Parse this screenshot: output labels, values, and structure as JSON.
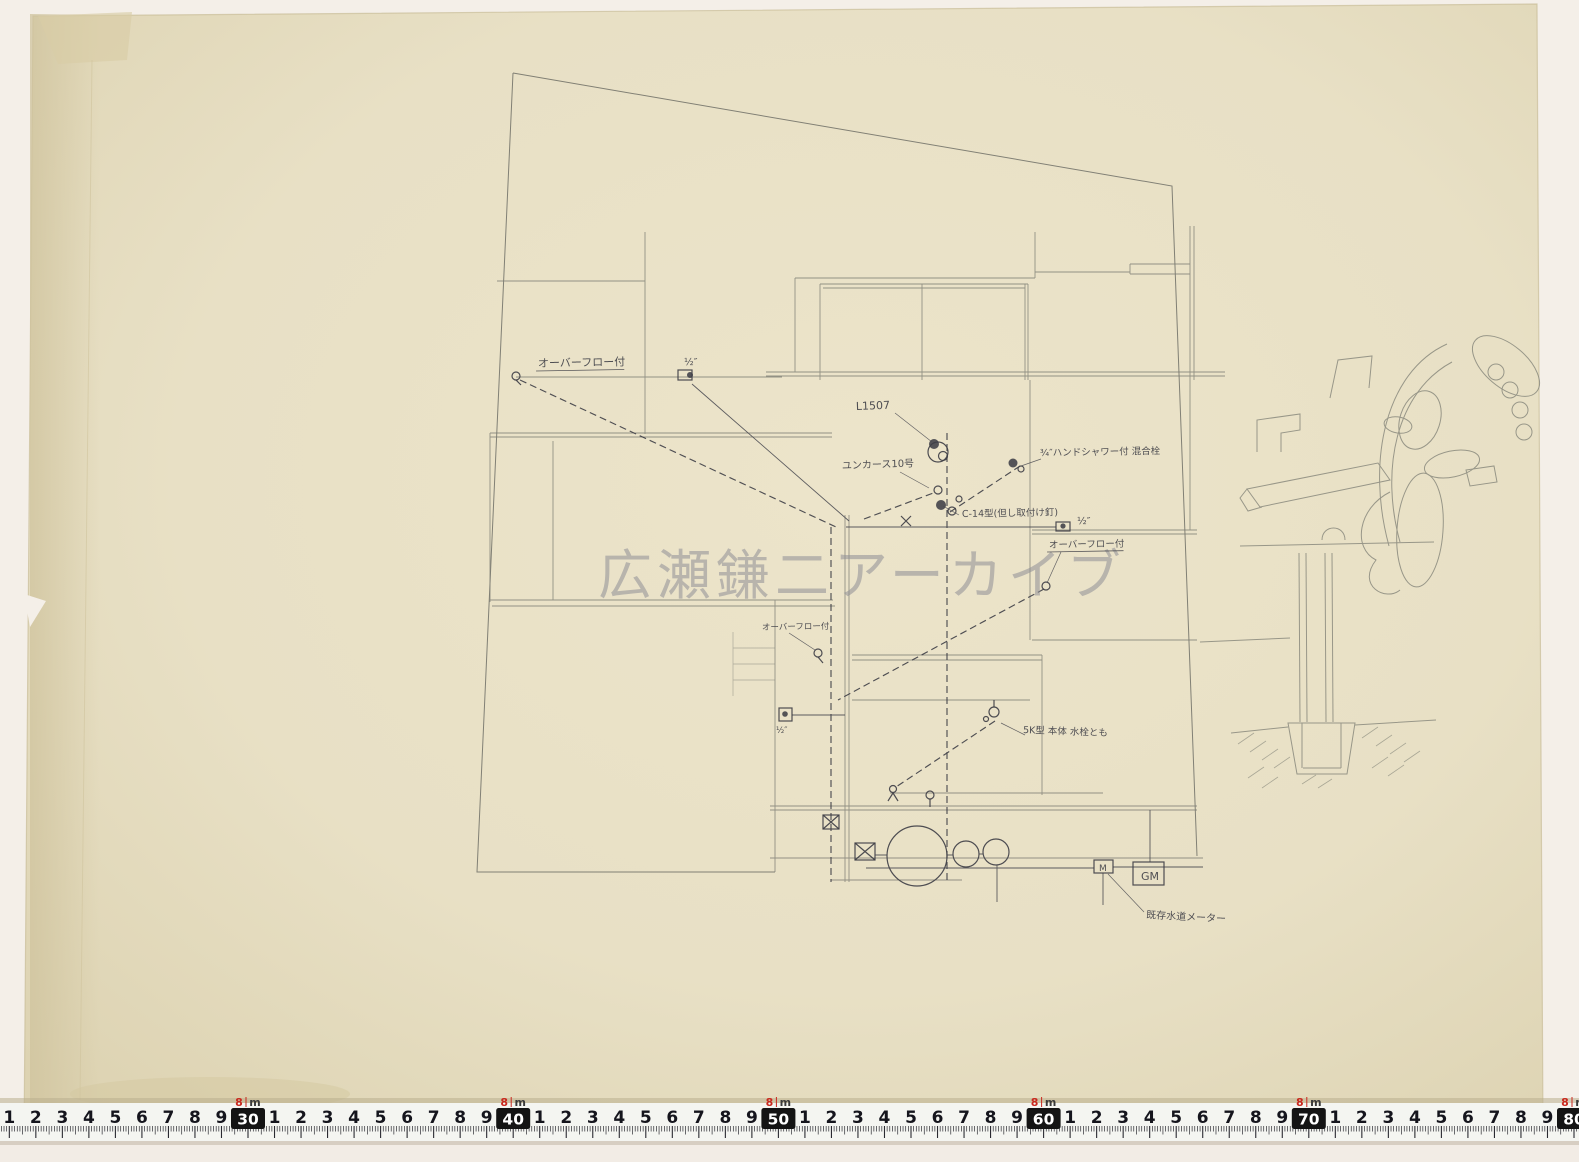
{
  "watermark": {
    "text": "広瀬鎌二アーカイブ",
    "color": "#8f8f96"
  },
  "annotations": [
    {
      "name": "note-overflow-1",
      "text": "オーバーフロー付",
      "x": 538,
      "y": 367,
      "size": 11,
      "rot": -1,
      "underline": true
    },
    {
      "name": "note-size-half-1",
      "text": "½″",
      "x": 684,
      "y": 365,
      "size": 10,
      "rot": 0,
      "underline": false
    },
    {
      "name": "note-l1507",
      "text": "L1507",
      "x": 856,
      "y": 410,
      "size": 11,
      "rot": -2,
      "underline": false
    },
    {
      "name": "note-junkers-10",
      "text": "ユンカース10号",
      "x": 842,
      "y": 469,
      "size": 10,
      "rot": -2,
      "underline": false
    },
    {
      "name": "note-hand-shower-mixer",
      "text": "¾″ハンドシャワー付 混合栓",
      "x": 1040,
      "y": 456,
      "size": 9.5,
      "rot": -1,
      "underline": false
    },
    {
      "name": "note-c14",
      "text": "C-14型(但し取付け釘)",
      "x": 962,
      "y": 517,
      "size": 9.5,
      "rot": -1,
      "underline": false
    },
    {
      "name": "note-size-half-2",
      "text": "½″",
      "x": 1077,
      "y": 524,
      "size": 10,
      "rot": 0,
      "underline": false
    },
    {
      "name": "note-overflow-2",
      "text": "オーバーフロー付",
      "x": 1049,
      "y": 548,
      "size": 9.5,
      "rot": -1,
      "underline": true
    },
    {
      "name": "note-overflow-3",
      "text": "オーバーフロー付",
      "x": 762,
      "y": 630,
      "size": 8.5,
      "rot": -1,
      "underline": false
    },
    {
      "name": "note-size-half-3",
      "text": "½″",
      "x": 776,
      "y": 733,
      "size": 8.5,
      "rot": 0,
      "underline": false
    },
    {
      "name": "note-5k-sink",
      "text": "5K型 本体 水栓とも",
      "x": 1023,
      "y": 733,
      "size": 9.5,
      "rot": 2,
      "underline": false
    },
    {
      "name": "label-water-meter-m",
      "text": "M",
      "x": 1099,
      "y": 871,
      "size": 9,
      "rot": 0,
      "underline": false
    },
    {
      "name": "label-gas-meter-gm",
      "text": "GM",
      "x": 1141,
      "y": 880,
      "size": 11,
      "rot": 0,
      "underline": false
    },
    {
      "name": "note-existing-water-meter",
      "text": "既存水道メーター",
      "x": 1146,
      "y": 918,
      "size": 10,
      "rot": 3,
      "underline": false
    }
  ],
  "ruler": {
    "meter_digit": "8",
    "meter_unit": "m",
    "decimeter_labels": [
      "30",
      "40",
      "50",
      "60",
      "70",
      "80"
    ],
    "cm_digits": [
      "1",
      "2",
      "3",
      "4",
      "5",
      "6",
      "7",
      "8",
      "9"
    ],
    "number_color": "#15151d",
    "accent_red": "#c9281e",
    "box_color": "#141414",
    "band_color": "#f4f5f1"
  }
}
